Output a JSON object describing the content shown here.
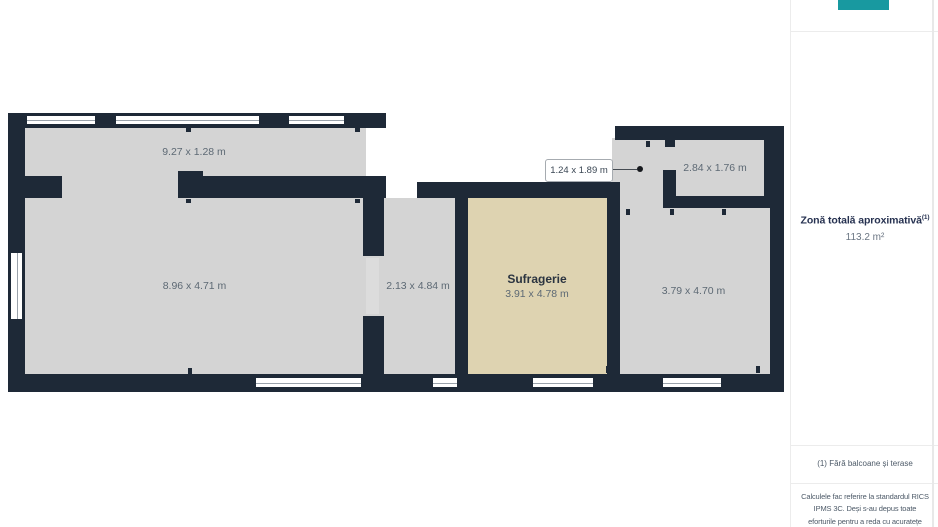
{
  "app": {
    "accent_color": "#1899a0"
  },
  "plan": {
    "colors": {
      "wall": "#1e2937",
      "room_fill": "#d4d4d4",
      "highlight_fill": "#ded3b1"
    },
    "rooms": [
      {
        "key": "balcony-strip",
        "dims": "9.27 x 1.28 m"
      },
      {
        "key": "large-room",
        "dims": "8.96 x 4.71 m"
      },
      {
        "key": "narrow-room",
        "dims": "2.13 x 4.84 m"
      },
      {
        "key": "living-room",
        "name": "Sufragerie",
        "dims": "3.91 x 4.78 m"
      },
      {
        "key": "right-room",
        "dims": "3.79 x 4.70 m"
      },
      {
        "key": "top-right-room",
        "dims": "2.84 x 1.76 m"
      }
    ],
    "callout": {
      "label": "1.24 x 1.89 m"
    }
  },
  "sidebar": {
    "area_title": "Zonă totală aproximativă",
    "area_title_sup": "(1)",
    "area_value": "113.2 m²",
    "footnote": "(1) Fără balcoane și terase",
    "disclaimer_lines": [
      "Calculele fac referire la standardul RICS",
      "IPMS 3C. Deși s-au depus toate",
      "eforturile pentru a reda cu acuratețe"
    ]
  }
}
